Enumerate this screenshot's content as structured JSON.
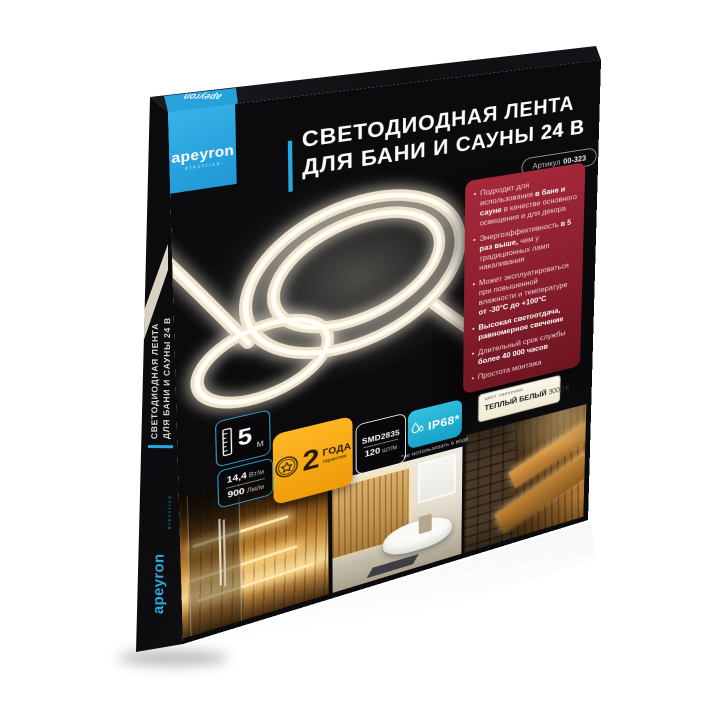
{
  "product": {
    "brand": "apeyron",
    "brand_tagline": "electrics",
    "title_line1": "СВЕТОДИОДНАЯ ЛЕНТА",
    "title_line2": "ДЛЯ БАНИ И САУНЫ",
    "title_voltage": "24 В",
    "article_label": "Артикул",
    "article_value": "00-323"
  },
  "side_panel": {
    "line1": "СВЕТОДИОДНАЯ ЛЕНТА",
    "line2": "ДЛЯ БАНИ И САУНЫ 24 В"
  },
  "features": [
    {
      "segments": [
        {
          "text": "Подходит для использования ",
          "bold": false
        },
        {
          "text": "в бане и сауне",
          "bold": true
        },
        {
          "text": " в качестве основного освещения и для декора",
          "bold": false
        }
      ]
    },
    {
      "segments": [
        {
          "text": "Энергоэффективность ",
          "bold": false
        },
        {
          "text": "в 5 раз выше,",
          "bold": true
        },
        {
          "text": " чем у традиционных ламп накаливания",
          "bold": false
        }
      ]
    },
    {
      "segments": [
        {
          "text": "Может эксплуатироваться при повышенной влажности и температуре ",
          "bold": false
        },
        {
          "text": "от -30°С до +100°С",
          "bold": true
        }
      ]
    },
    {
      "segments": [
        {
          "text": "Высокая светоотдача, равномерное свечение",
          "bold": true
        }
      ]
    },
    {
      "segments": [
        {
          "text": "Длительный срок службы ",
          "bold": false
        },
        {
          "text": "более 40 000 часов",
          "bold": true
        }
      ]
    },
    {
      "segments": [
        {
          "text": "Простота монтажа",
          "bold": false
        }
      ]
    }
  ],
  "specs": {
    "length": {
      "value": "5",
      "unit": "м"
    },
    "power": {
      "value": "14,4",
      "unit": "Вт/м"
    },
    "lumens": {
      "value": "900",
      "unit": "Лм/м"
    },
    "warranty": {
      "value": "2",
      "unit": "ГОДА",
      "sub": "гарантия"
    },
    "led_type": "SMD2835",
    "density": {
      "value": "120",
      "unit": "шт/м"
    },
    "ip_rating": "IP68*",
    "ip_note": "*не использовать в воде"
  },
  "light_color": {
    "label": "цвет свечения",
    "name": "ТЕПЛЫЙ БЕЛЫЙ",
    "temp": "3000 К"
  },
  "colors": {
    "brand_blue": "#2aa7e0",
    "panel_red": "#8e2030",
    "warranty_yellow": "#f6a71b",
    "ip_cyan": "#25b5d6",
    "badge_border_blue": "#2f9fd6",
    "cream": "#f7f3e2",
    "strip_glow": "#f5e9d2"
  }
}
